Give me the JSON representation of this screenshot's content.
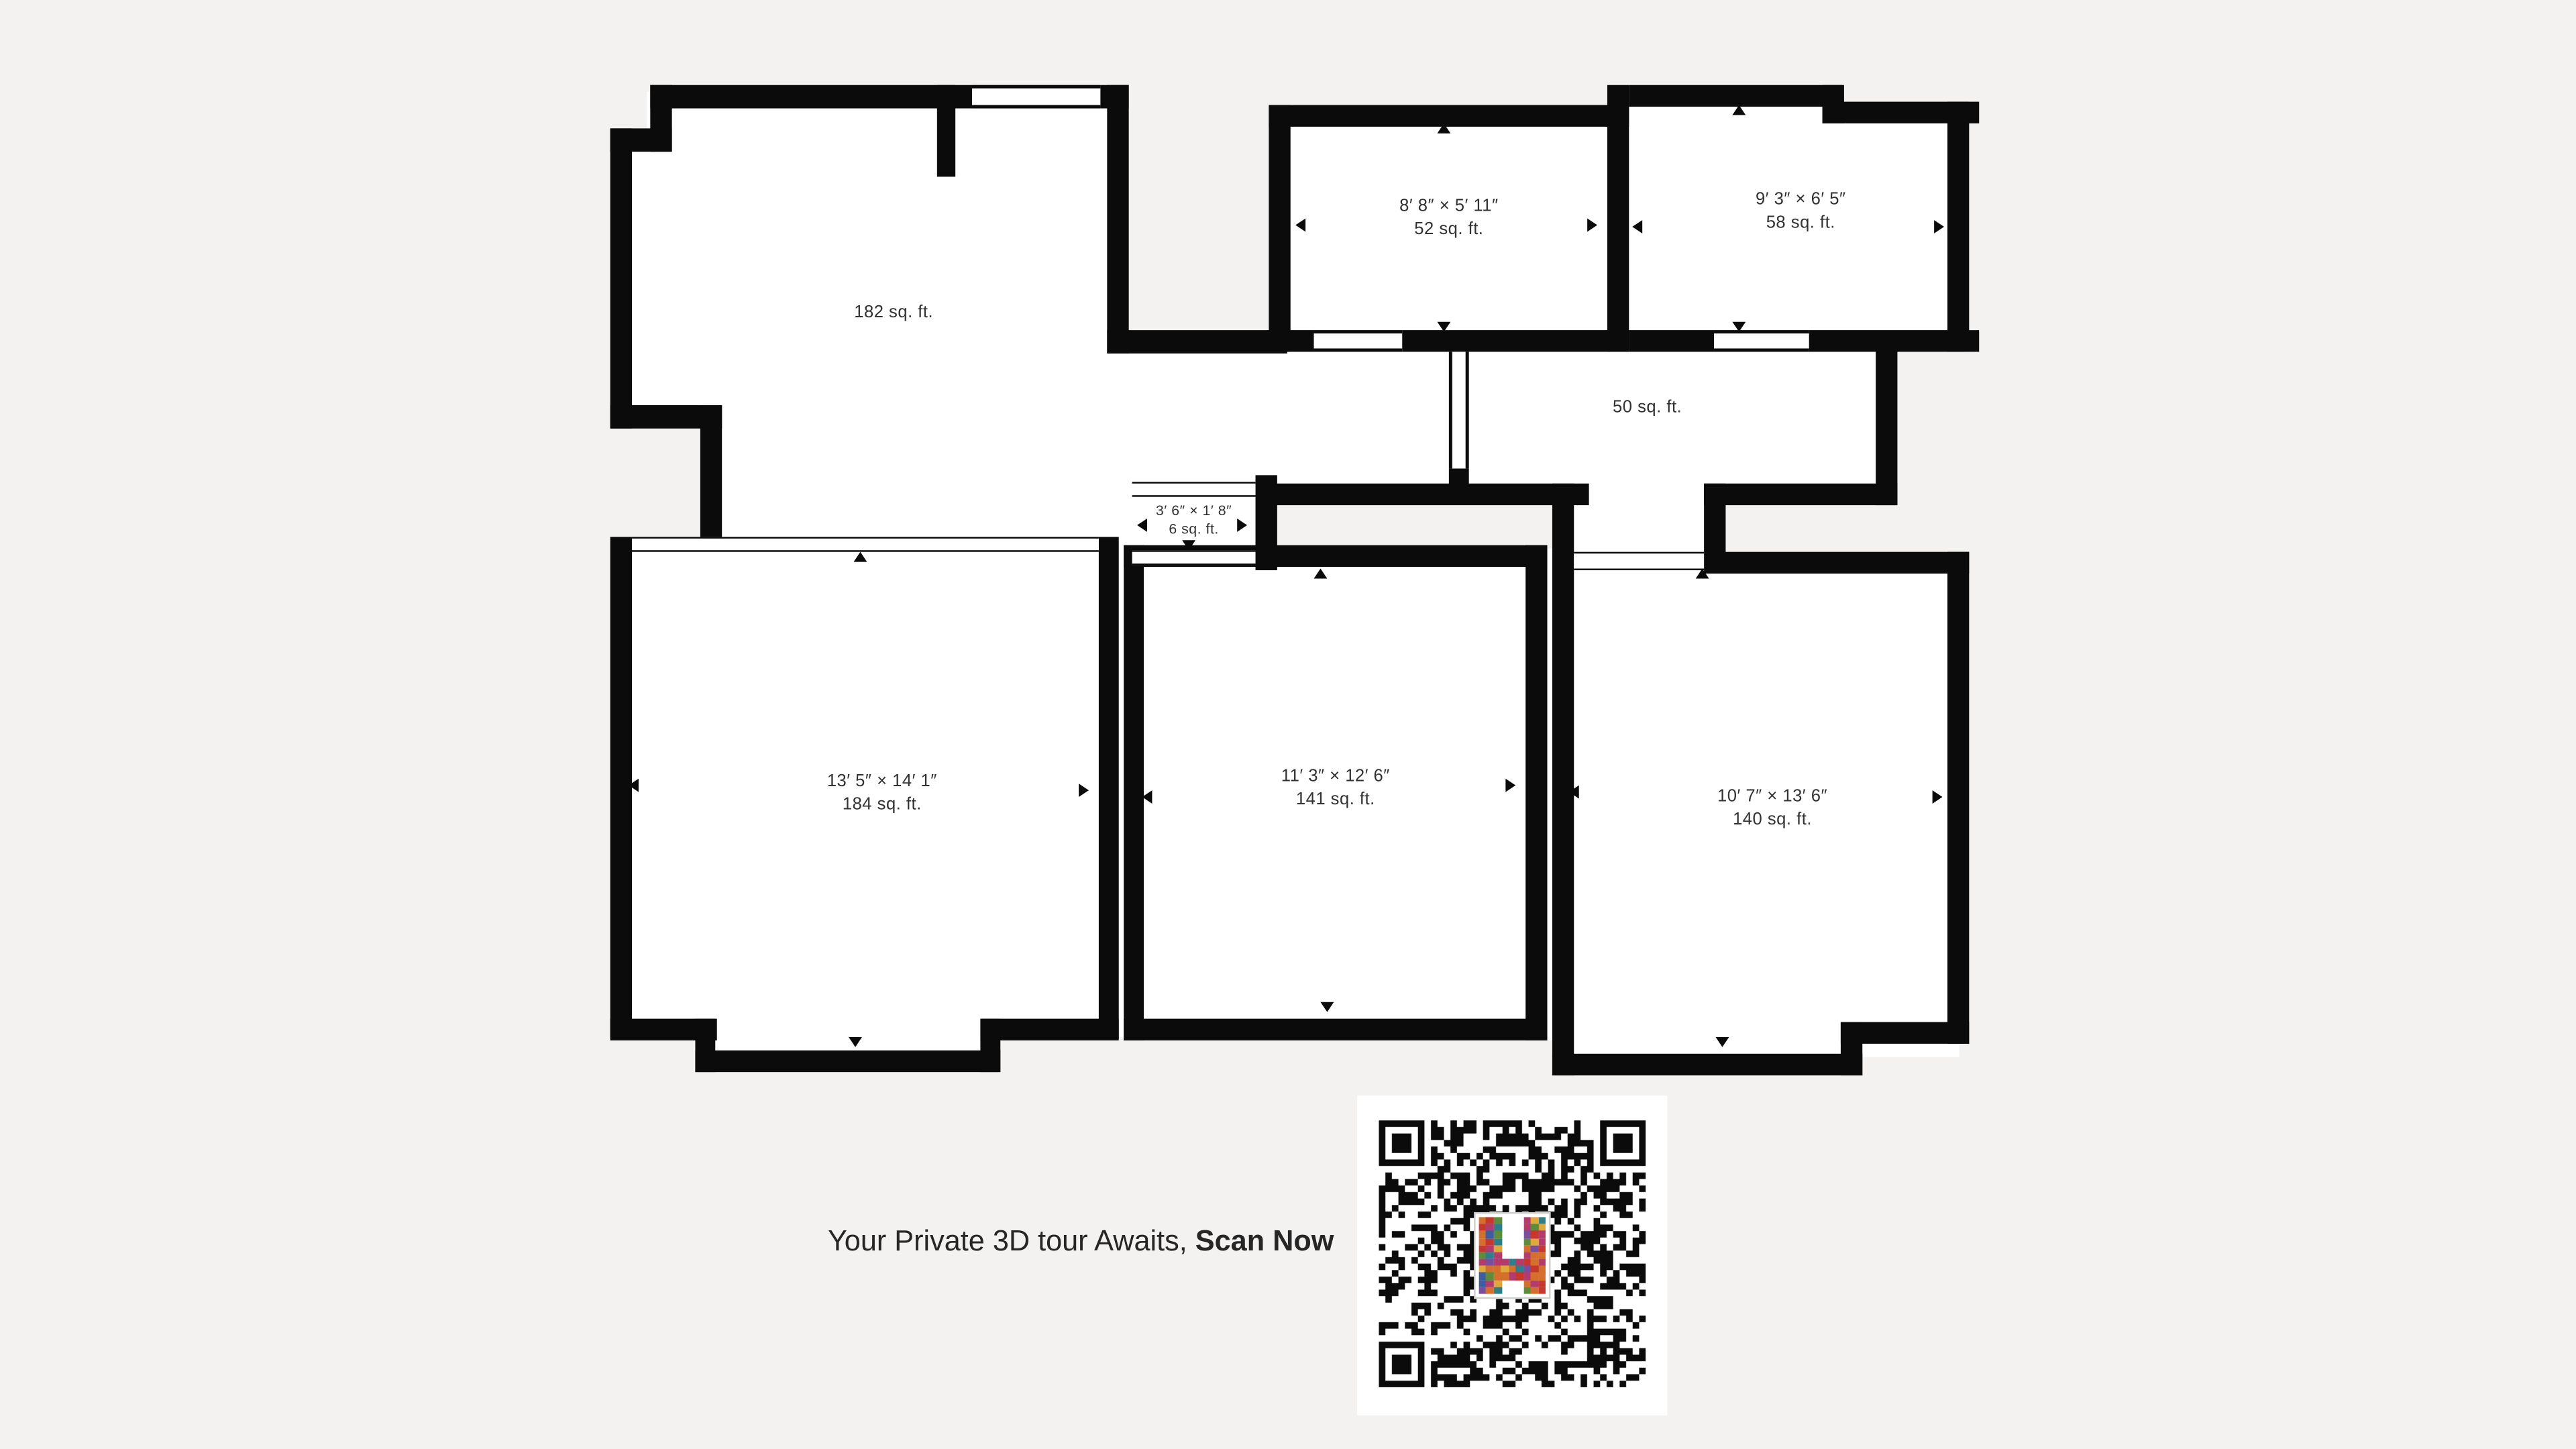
{
  "cta": {
    "line1": "Your Private 3D tour Awaits,",
    "line2": "Scan Now"
  },
  "floorplan": {
    "rooms": [
      {
        "id": "area-182",
        "area": "182 sq. ft."
      },
      {
        "id": "room-52",
        "dims": "8′ 8″ × 5′ 11″",
        "area": "52 sq. ft."
      },
      {
        "id": "room-58",
        "dims": "9′ 3″ × 6′ 5″",
        "area": "58 sq. ft."
      },
      {
        "id": "hall-50",
        "area": "50 sq. ft."
      },
      {
        "id": "closet-6",
        "dims": "3′ 6″ × 1′ 8″",
        "area": "6 sq. ft."
      },
      {
        "id": "room-184",
        "dims": "13′ 5″ × 14′ 1″",
        "area": "184 sq. ft."
      },
      {
        "id": "room-141",
        "dims": "11′ 3″ × 12′ 6″",
        "area": "141 sq. ft."
      },
      {
        "id": "room-140",
        "dims": "10′ 7″ × 13′ 6″",
        "area": "140 sq. ft."
      }
    ]
  },
  "qr": {
    "type": "qr-code",
    "center_logo": "colorful-mosaic-H"
  },
  "colors": {
    "background": "#f4f2f0",
    "wall": "#0b0b0b",
    "room": "#ffffff",
    "label": "#323232",
    "logo_palette": [
      "#c8372d",
      "#2e7e8c",
      "#dfa83a",
      "#d4702c",
      "#3c5ea1",
      "#7a4d9e",
      "#5d8c3a",
      "#b43b6e"
    ]
  }
}
